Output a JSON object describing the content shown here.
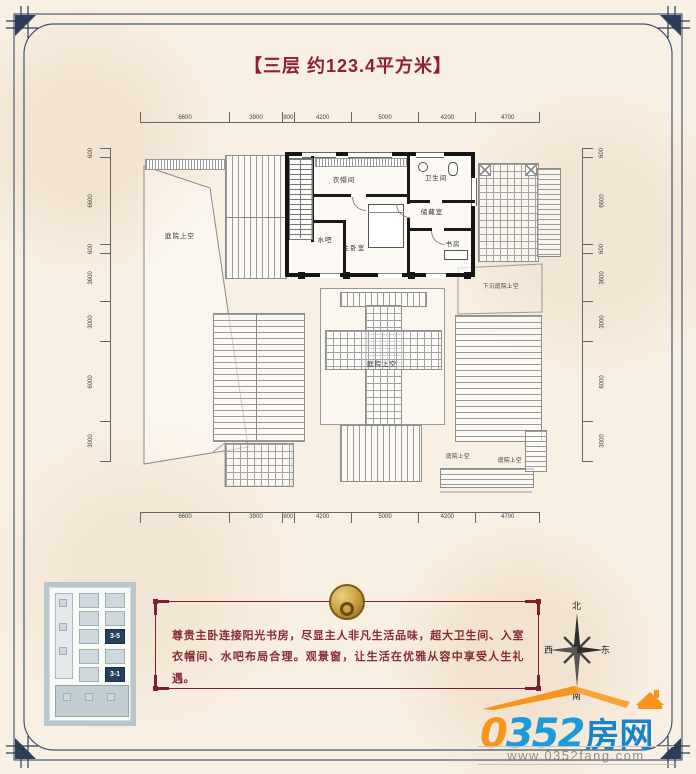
{
  "title": "【三层  约123.4平方米】",
  "plan": {
    "rooms": {
      "closet": "衣帽间",
      "bath": "卫生间",
      "storage": "储藏室",
      "master": "主卧室",
      "waterbar": "水吧",
      "study": "书房"
    },
    "labels": {
      "courtyard": "庭院上空",
      "sunken": "下沉庭院上空"
    },
    "dims_top": [
      "6600",
      "3900",
      "800",
      "4200",
      "5000",
      "4200",
      "4700"
    ],
    "dims_bottom": [
      "6600",
      "3900",
      "800",
      "4200",
      "5000",
      "4200",
      "4700"
    ],
    "dims_left": [
      "600",
      "6600",
      "600",
      "3600",
      "3000",
      "6000",
      "3000"
    ],
    "dims_right": [
      "600",
      "6600",
      "600",
      "3600",
      "3000",
      "6000",
      "3000"
    ]
  },
  "description": {
    "text": "尊贵主卧连接阳光书房，尽显主人非凡生活品味，超大卫生间、入室衣帽间、水吧布局合理。观景窗，让生活在优雅从容中享受人生礼遇。"
  },
  "compass": {
    "north": "北",
    "south": "南",
    "east": "东",
    "west": "西"
  },
  "keyplan": {
    "unit_a": "3-5",
    "unit_b": "3-1"
  },
  "logo": {
    "zero": "0",
    "digits": "352",
    "name": "房网",
    "url": "www.0352fang.com"
  },
  "colors": {
    "accent_red": "#8e1f31",
    "frame_navy": "#2b3d58",
    "logo_blue": "#1b9cd8",
    "logo_orange": "#f7941d",
    "highlight_navy": "#24425e"
  }
}
